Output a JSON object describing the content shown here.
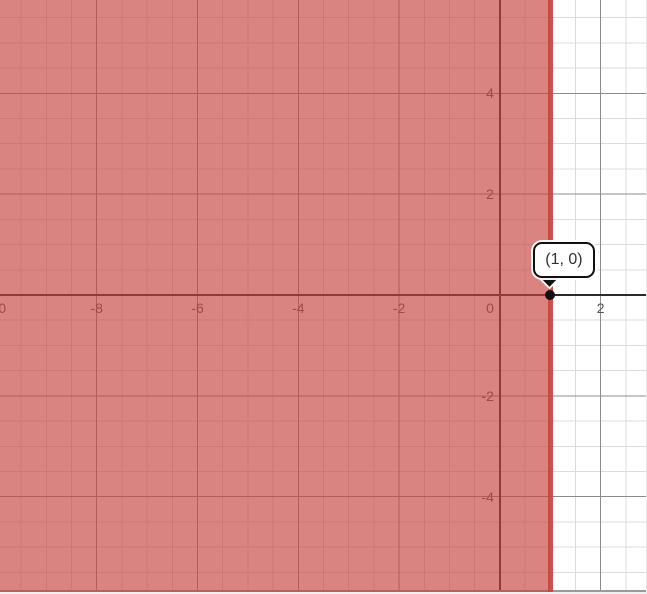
{
  "chart_data": {
    "type": "region",
    "title": "",
    "description": "Coordinate plane with the half-plane x ≤ 1 shaded and the boundary point (1, 0) marked",
    "inequality": {
      "boundary_x": 1,
      "shaded_side": "left",
      "boundary_style": "solid"
    },
    "point": {
      "x": 1,
      "y": 0,
      "label": "(1, 0)"
    },
    "axes": {
      "x": {
        "range": [
          -9.92,
          2.92
        ],
        "major_step": 2,
        "minor_step": 0.5,
        "tick_values": [
          -10,
          -8,
          -6,
          -4,
          -2,
          0,
          2
        ],
        "tick_labels": [
          "-10",
          "-8",
          "-6",
          "-4",
          "-2",
          "0",
          "2"
        ]
      },
      "y": {
        "range": [
          -5.93,
          5.85
        ],
        "major_step": 2,
        "minor_step": 0.5,
        "tick_values": [
          4,
          2,
          -2,
          -4
        ],
        "tick_labels": [
          "4",
          "2",
          "-2",
          "-4"
        ]
      }
    },
    "grid": true,
    "legend": false,
    "colors": {
      "region_fill": "rgba(199,68,64,0.66)",
      "boundary_line": "rgba(199,68,64,0.92)",
      "minor_grid": "#dcdcdc",
      "major_grid": "#8c8c8c",
      "axis": "#2a2a2a",
      "tick_text": "#555555",
      "point": "#111111",
      "bottom_border": "#9a9a9a",
      "bottom_margin": "#f0f0f0"
    }
  }
}
